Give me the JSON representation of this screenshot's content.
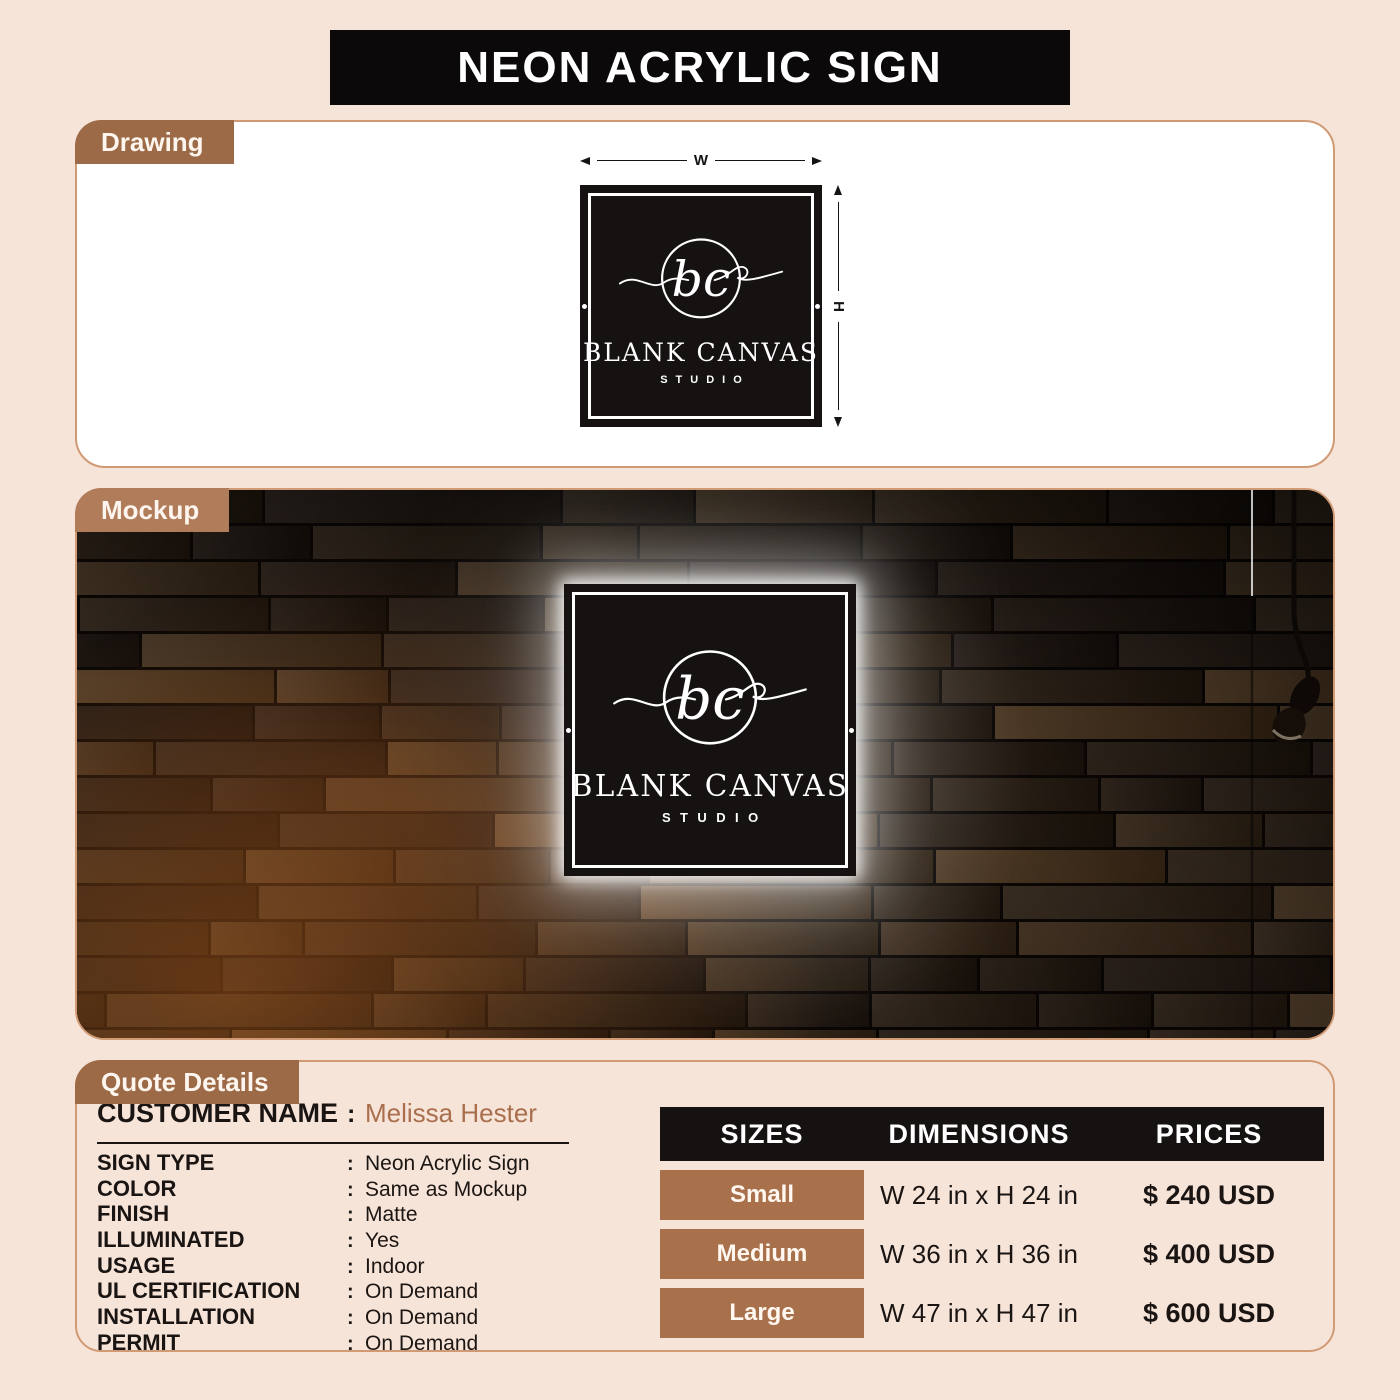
{
  "page": {
    "title": "NEON ACRYLIC SIGN",
    "colors": {
      "background": "#f7e4d9",
      "tab_brown": "#9c6a46",
      "mockup_tab_brown": "#b17c5a",
      "size_chip_brown": "#a8714c",
      "panel_border_tan": "#d09a74",
      "title_bar_black": "#0b0909",
      "table_header_black": "#171212",
      "customer_name_brown": "#a96f4d",
      "sign_black": "#151211",
      "neon_glow_white": "#ffffff"
    },
    "icons": {
      "pendant_light": "pendant-light-icon (css/svg shape)",
      "mounting_hole": "white dot",
      "brand_logo": "circle monogram with swash",
      "dimension_arrows": "double-headed arrows"
    }
  },
  "sections": {
    "drawing_label": "Drawing",
    "mockup_label": "Mockup",
    "quote_label": "Quote Details"
  },
  "sign": {
    "monogram": "bc",
    "brand": "BLANK CANVAS",
    "sub_brand": "STUDIO",
    "width_label": "W",
    "height_label": "H"
  },
  "quote": {
    "colon": ":",
    "customer_label": "CUSTOMER NAME",
    "customer_value": "Melissa Hester",
    "rows": [
      {
        "label": "SIGN TYPE",
        "value": "Neon Acrylic Sign"
      },
      {
        "label": "COLOR",
        "value": "Same as Mockup"
      },
      {
        "label": "FINISH",
        "value": "Matte"
      },
      {
        "label": "ILLUMINATED",
        "value": "Yes"
      },
      {
        "label": "USAGE",
        "value": "Indoor"
      },
      {
        "label": "UL CERTIFICATION",
        "value": "On Demand"
      },
      {
        "label": "INSTALLATION",
        "value": "On Demand"
      },
      {
        "label": "PERMIT",
        "value": "On Demand"
      }
    ]
  },
  "pricing": {
    "headers": {
      "sizes": "SIZES",
      "dimensions": "DIMENSIONS",
      "prices": "PRICES"
    },
    "rows": [
      {
        "size": "Small",
        "dimensions": "W 24 in x H 24 in",
        "price": "$ 240 USD"
      },
      {
        "size": "Medium",
        "dimensions": "W 36 in x H 36 in",
        "price": "$ 400 USD"
      },
      {
        "size": "Large",
        "dimensions": "W 47 in x H 47 in",
        "price": "$ 600 USD"
      }
    ]
  }
}
